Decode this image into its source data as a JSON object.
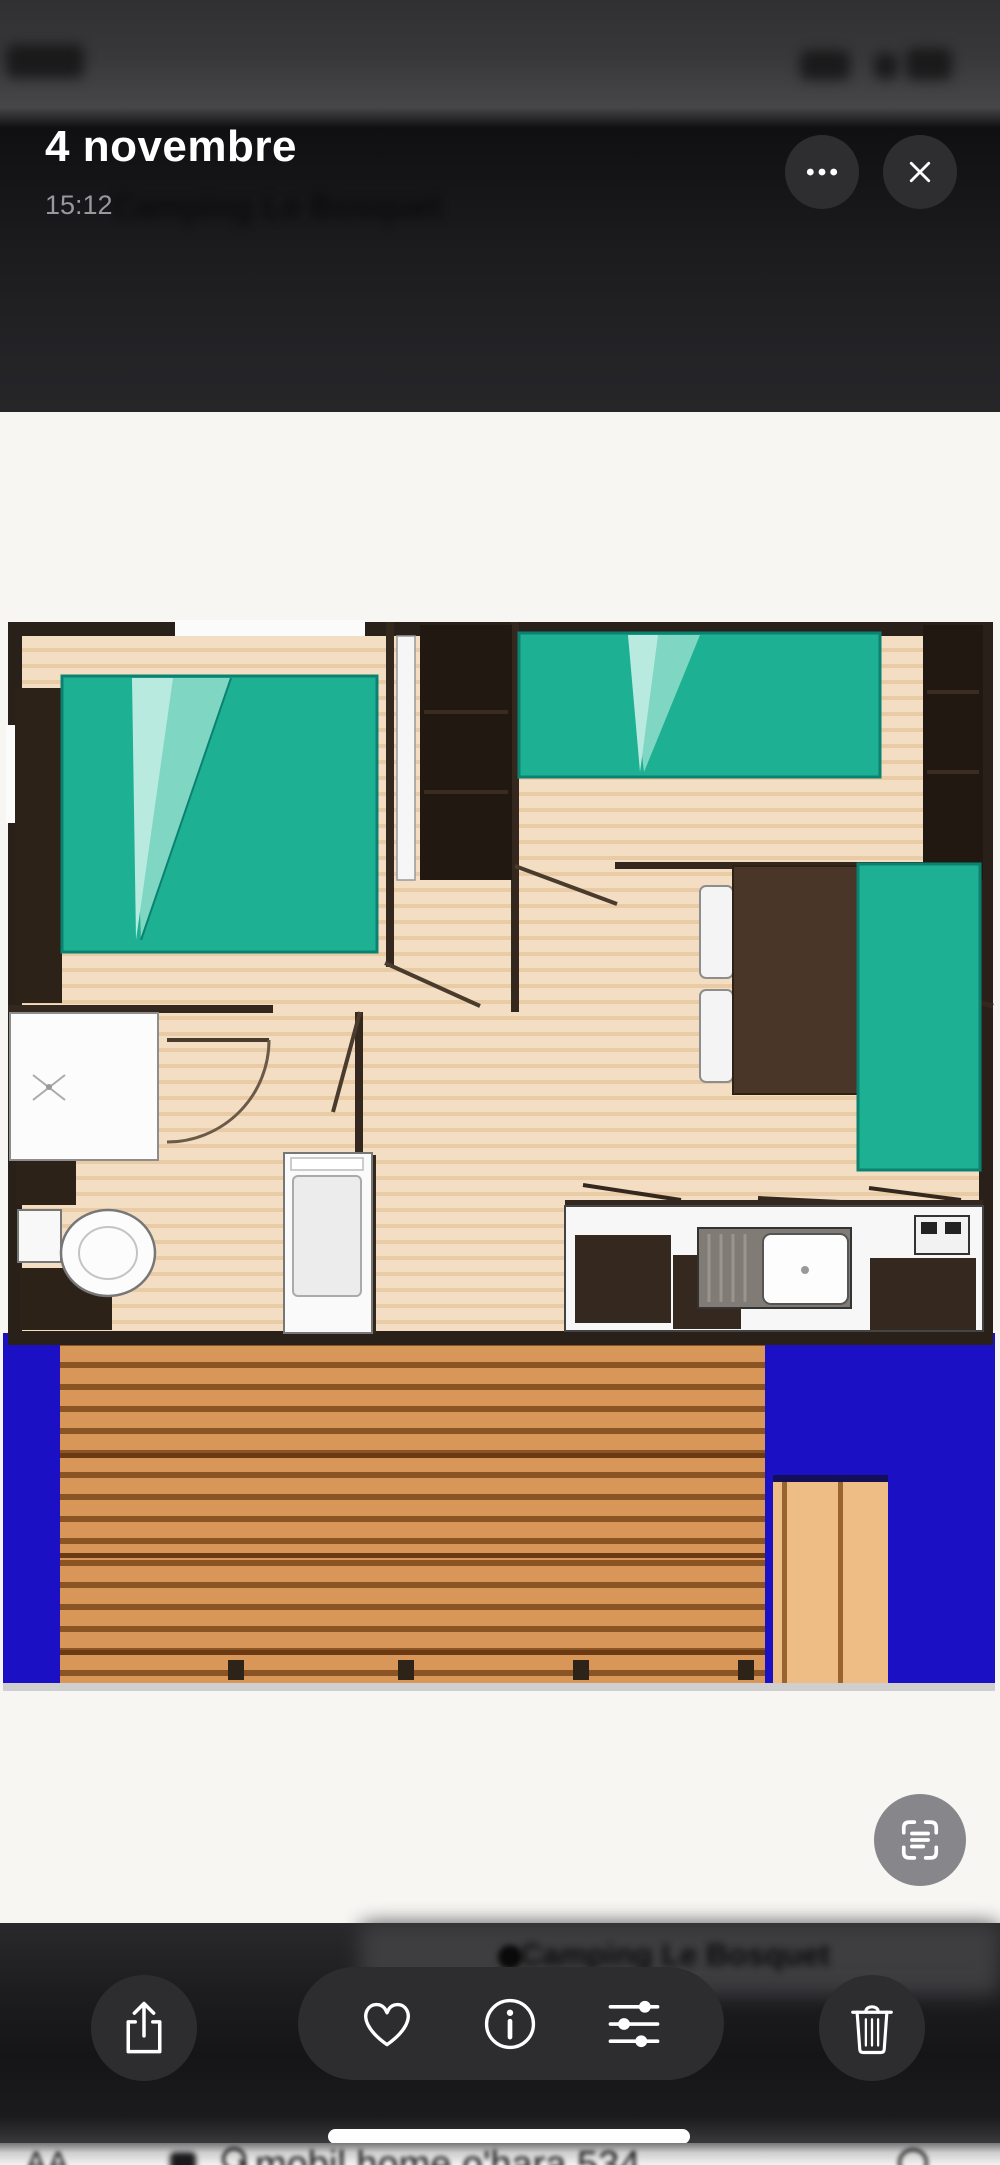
{
  "header": {
    "title": "4 novembre",
    "time": "15:12",
    "more_icon": "ellipsis-icon",
    "close_icon": "x-icon"
  },
  "background_blur": {
    "site_name": "Camping Le Bosquet",
    "status_bar": "blurred time, signal, wifi and battery glyphs"
  },
  "photo": {
    "kind": "mobile-home floor plan screenshot",
    "colors": {
      "bed_teal": "#1db093",
      "bed_fold_light": "#7fd7c3",
      "wall_dark_brown": "#2c2218",
      "floor_wood": "#f3dec3",
      "terrace_blue": "#1b10c4",
      "deck_wood": "#d89758",
      "furniture_brown": "#4a3628"
    }
  },
  "toolbar": {
    "buttons": [
      {
        "name": "share",
        "icon": "share-icon"
      },
      {
        "name": "favorite",
        "icon": "heart-icon"
      },
      {
        "name": "info",
        "icon": "info-icon"
      },
      {
        "name": "adjust",
        "icon": "adjustments-icon"
      },
      {
        "name": "delete",
        "icon": "trash-icon"
      }
    ],
    "live_text_icon": "live-text-icon"
  },
  "safari_bar": {
    "reader_button": "AA",
    "search_text": "mobil home o'hara 534"
  }
}
